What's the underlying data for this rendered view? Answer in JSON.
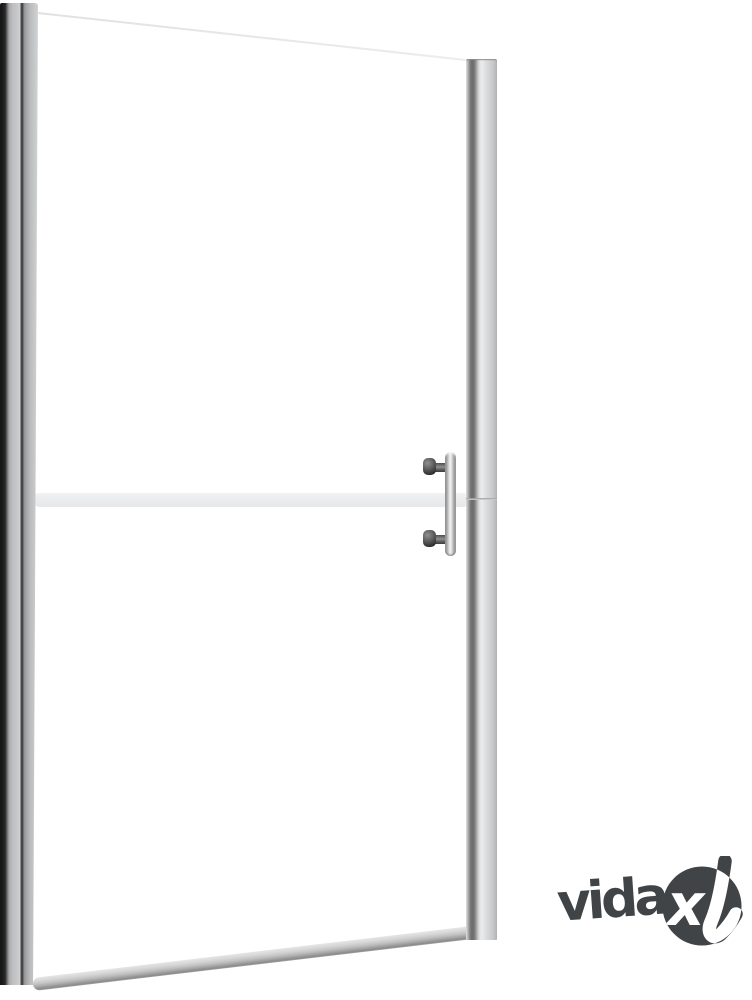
{
  "page": {
    "background": "#ffffff",
    "alt": "Product photo of a frameless hinged shower door: two aluminium side profiles, clear glass with one horizontal frosted stripe, vertical bar handle and a slanted bottom rail, brand watermark bottom right"
  },
  "brand": {
    "wordmark": "vida",
    "badge_x": "x",
    "color": "#414447",
    "badge_text_color": "#ffffff"
  },
  "colors": {
    "background": "#ffffff",
    "frame_silver": "#c9cacc",
    "frame_dark_edge": "#1d1d1d",
    "frame_dark_band": "#6e6e6f",
    "frosted_stripe": "#ebecee",
    "handle_metal": "#e9e9e9",
    "handle_mount_dark": "#3c3c3c",
    "glass_edge_line": "#dcdcdd",
    "bottom_rail": "#b5b5b6"
  }
}
